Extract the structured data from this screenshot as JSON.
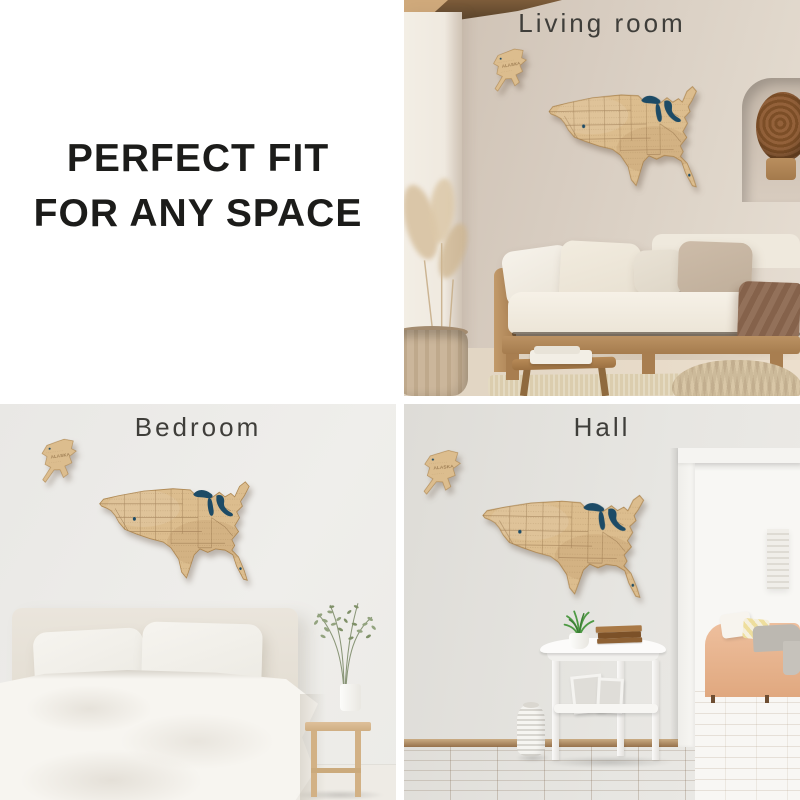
{
  "headline": {
    "lines": [
      "PERFECT FIT",
      "FOR ANY SPACE"
    ],
    "text_color": "#1c1c1a"
  },
  "scenes": {
    "living_room": {
      "label": "Living room",
      "wall_color": "#d6cabd"
    },
    "bedroom": {
      "label": "Bedroom",
      "wall_color": "#edecea"
    },
    "hall": {
      "label": "Hall",
      "wall_color": "#e5e4e0"
    }
  },
  "map": {
    "alaska_label": "ALASKA",
    "wood_color": "#dcbd8e",
    "lakes_color": "#1d4b66",
    "engraving_color": "#7b5a33"
  }
}
